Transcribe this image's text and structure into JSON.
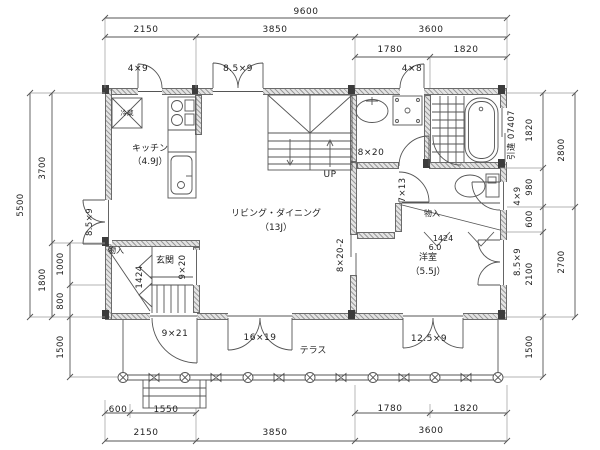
{
  "dims": {
    "top": {
      "overall": "9600",
      "d2150": "2150",
      "d3850": "3850",
      "d3600": "3600",
      "d1780": "1780",
      "d1820": "1820"
    },
    "bottom": {
      "d600": "600",
      "d1550": "1550",
      "d2150": "2150",
      "d3850": "3850",
      "d3600": "3600",
      "d1780": "1780",
      "d1820": "1820"
    },
    "left": {
      "d5500": "5500",
      "d3700": "3700",
      "d1800": "1800",
      "d1000": "1000",
      "d800": "800",
      "d1500": "1500"
    },
    "right": {
      "d2800": "2800",
      "d2700": "2700",
      "d1820": "1820",
      "d980": "980",
      "d600": "600",
      "d2100": "2100",
      "d1500": "1500"
    }
  },
  "rooms": {
    "kitchen": {
      "name": "キッチン",
      "size": "（4.9J）"
    },
    "living": {
      "name": "リビング・ダイニング",
      "size": "（13J）"
    },
    "bedroom": {
      "name": "洋室",
      "size": "（5.5J）"
    },
    "entrance": {
      "name": "玄関"
    },
    "terrace": {
      "name": "テラス"
    },
    "closet_entrance": {
      "name": "物入"
    },
    "closet_bedroom": {
      "name": "物入"
    },
    "stairs": {
      "direction": "UP"
    },
    "fridge": {
      "name": "冷蔵"
    }
  },
  "openings": {
    "top_kitchen_door": "4×9",
    "top_double_door": "8.5×9",
    "top_utility_door": "4×8",
    "left_double_door": "8.5×9",
    "right_sliding_window": "引違 07407",
    "right_door": "4×9",
    "right_double_door": "8.5×9",
    "stair_hall_window": "8×20",
    "living_hall_sliding": "8×20-2",
    "toilet_door": "7×13",
    "entrance_hall_door": "9×20",
    "entrance_step": "1424",
    "closet_front": "1424",
    "closet_front_sub": "6.0",
    "entrance_door": "9×21",
    "living_terrace_door": "16×19",
    "bedroom_terrace_door": "12.5×9"
  },
  "colors": {
    "line": "#555555",
    "wall": "#9c9c9c",
    "text": "#222222",
    "background": "#ffffff"
  }
}
